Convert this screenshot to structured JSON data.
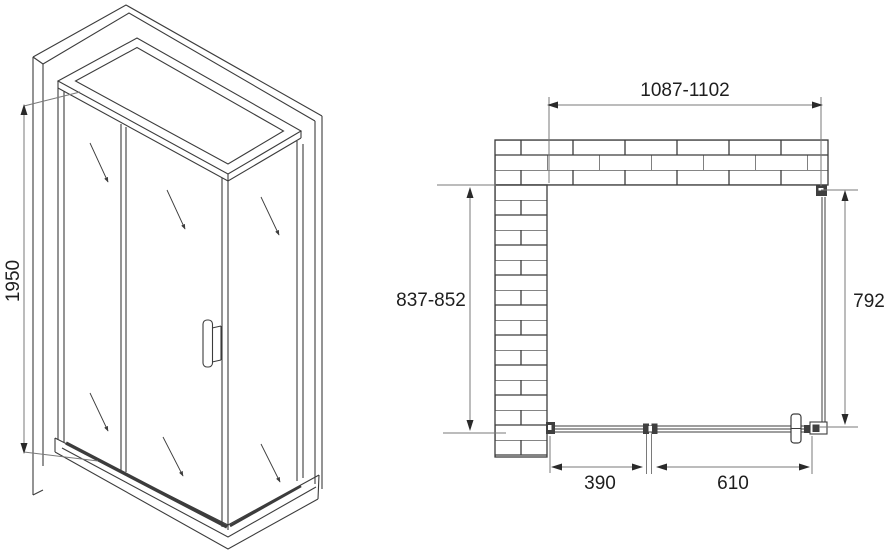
{
  "drawing": {
    "subject": "shower-enclosure-technical-drawing",
    "background_color": "#ffffff",
    "line_color": "#3c3c3c",
    "dimension_line_color": "#7a7a7a",
    "arrow_color": "#2a2a2a",
    "text_color": "#1e1e1e",
    "views": {
      "isometric": {
        "label": "isometric-view"
      },
      "plan": {
        "label": "top-plan-view"
      }
    },
    "dimensions": {
      "height": "1950",
      "width_range": "1087-1102",
      "wall_depth_range": "837-852",
      "side_panel_depth": "792",
      "fixed_segment": "390",
      "door_segment": "610"
    }
  }
}
